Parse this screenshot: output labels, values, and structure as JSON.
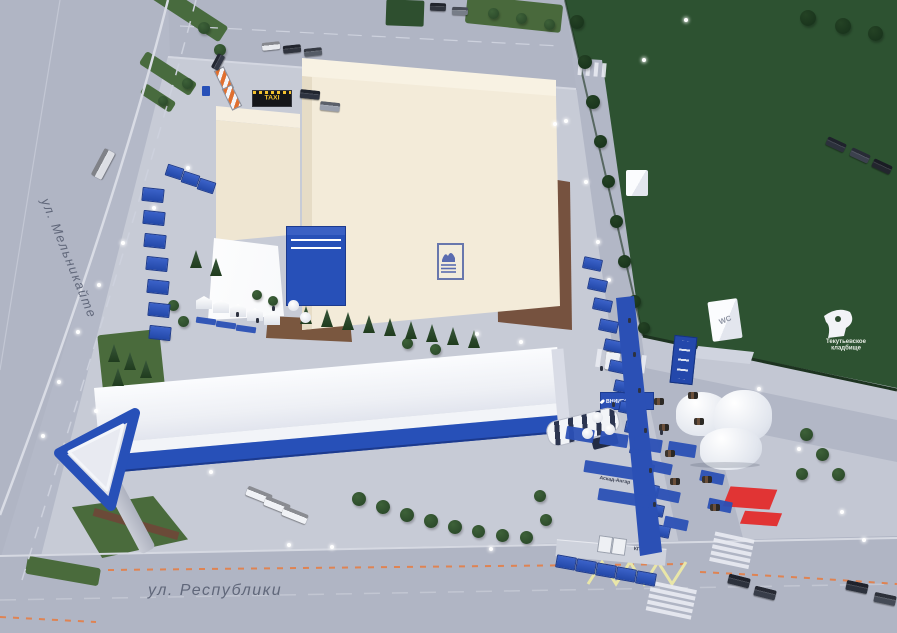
{
  "streets": {
    "left": "ул. Мельникайте",
    "bottom": "ул. Республики"
  },
  "signs": {
    "taxi": "TAXI",
    "vniigaz": "ВНИИГАЗ",
    "wc": "WC",
    "cemetery": "Текутьевское кладбище",
    "checkpoint": "КПП",
    "alley": "Аскад-Ангар"
  },
  "colors": {
    "road": "#b1b6c5",
    "site_pavement": "#c7cbd6",
    "field_green": "#2d5231",
    "lawn_green": "#4a6b3c",
    "accent_blue": "#2750b8",
    "building_cream": "#f3ebd9",
    "building_white_roof": "#f7f9fc",
    "brown_paving": "#76523f",
    "red_marking": "#e13434",
    "zigzag_yellow": "#e9e6a8",
    "dash_orange": "#df8352"
  }
}
